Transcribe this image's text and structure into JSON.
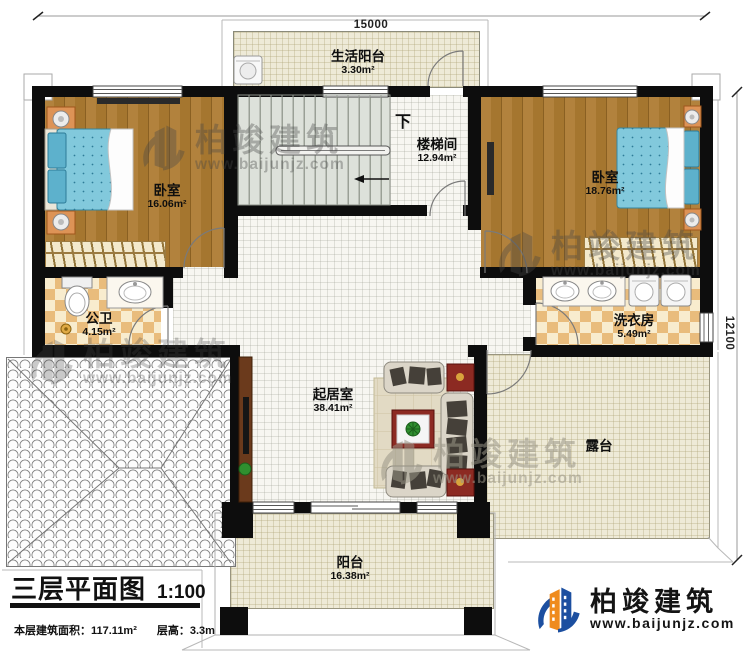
{
  "drawing": {
    "type": "architectural-floor-plan",
    "dimensions": {
      "top": "15000",
      "right": "12100"
    },
    "rooms": [
      {
        "id": "living_balcony",
        "name": "生活阳台",
        "area": "3.30m²"
      },
      {
        "id": "stairwell",
        "name": "楼梯间",
        "area": "12.94m²",
        "direction_label": "下"
      },
      {
        "id": "bedroom_left",
        "name": "卧室",
        "area": "16.06m²"
      },
      {
        "id": "bedroom_right",
        "name": "卧室",
        "area": "18.76m²"
      },
      {
        "id": "bathroom",
        "name": "公卫",
        "area": "4.15m²"
      },
      {
        "id": "laundry",
        "name": "洗衣房",
        "area": "5.49m²"
      },
      {
        "id": "living_room",
        "name": "起居室",
        "area": "38.41m²"
      },
      {
        "id": "terrace",
        "name": "露台"
      },
      {
        "id": "balcony",
        "name": "阳台",
        "area": "16.38m²"
      }
    ],
    "title_block": {
      "title": "三层平面图",
      "scale": "1:100",
      "area_label": "本层建筑面积：",
      "area_value": "117.11m²",
      "height_label": "层高：",
      "height_value": "3.3m"
    },
    "branding": {
      "company": "柏竣建筑",
      "website": "www.baijunjz.com"
    }
  }
}
